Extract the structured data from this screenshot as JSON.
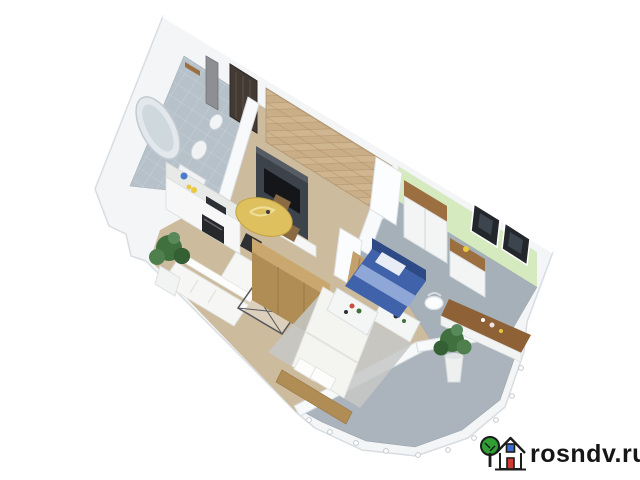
{
  "watermark": {
    "text": "rosndv.ru",
    "icon": "house-with-tree-logo",
    "colors": {
      "tree": "#2f9e33",
      "door": "#d23b33",
      "window": "#3f6bc9",
      "outline": "#1c1c1c",
      "text": "#161616"
    }
  },
  "scene": {
    "type": "isometric-3d-floor-plan",
    "rooms": [
      {
        "name": "bathroom",
        "floor": "tile",
        "floor_color": "#b6c1c9"
      },
      {
        "name": "entry-hallway",
        "floor": "wood",
        "floor_color": "#cdbb9e",
        "feature": "herringbone-wood-wall"
      },
      {
        "name": "kitchen-living-room",
        "floor": "wood",
        "floor_color": "#cdbb9e"
      },
      {
        "name": "master-bedroom",
        "floor": "wood",
        "floor_color": "#cdbb9e"
      },
      {
        "name": "kids-room",
        "floor": "carpet",
        "floor_color": "#a6b0b8",
        "accent_wall_color": "#d6eabf"
      },
      {
        "name": "balcony",
        "floor": "concrete",
        "floor_color": "#abb4bc"
      }
    ],
    "palette": {
      "wall_white": "#f3f5f7",
      "wall_edge": "#d8dde2",
      "wood_light": "#c9ae88",
      "wood_mid": "#b08d55",
      "wood_dark": "#8e6136",
      "bed_navy": "#3f62ab",
      "tv_dark": "#3d434b",
      "table_yellow": "#dfc05e",
      "plant_green": "#41703f"
    }
  }
}
